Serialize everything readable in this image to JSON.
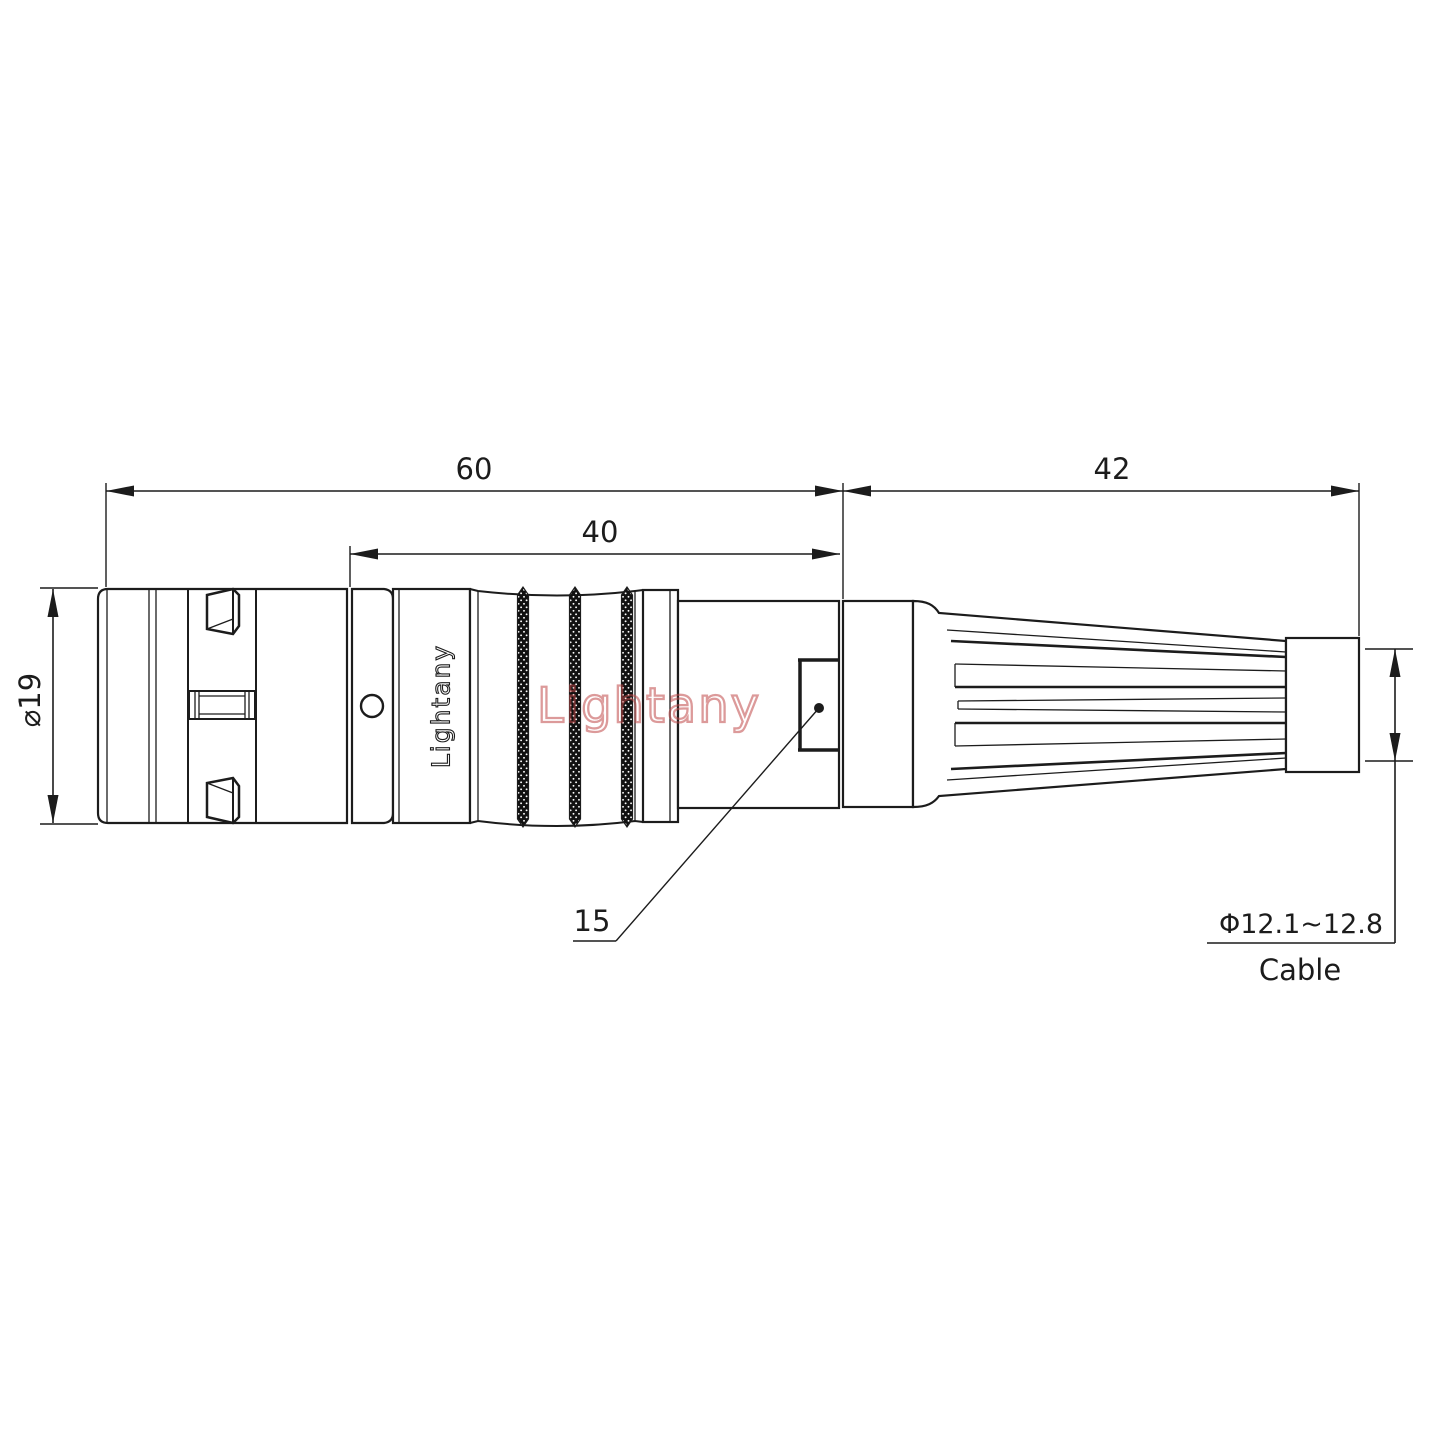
{
  "page": {
    "background": "#ffffff"
  },
  "drawing": {
    "dimensions": {
      "total_length": "60",
      "mid_length": "40",
      "rear_length": "42",
      "shell_diameter": "⌀19",
      "nut_callout": "15",
      "cable_range": "Φ12.1~12.8",
      "cable_label": "Cable"
    },
    "branding": {
      "product_marking": "Lightany",
      "watermark": "Lightany"
    },
    "colors": {
      "line": "#1c1c1c",
      "watermark_stroke": "#c04848",
      "knurl_fill": "#111111"
    }
  }
}
